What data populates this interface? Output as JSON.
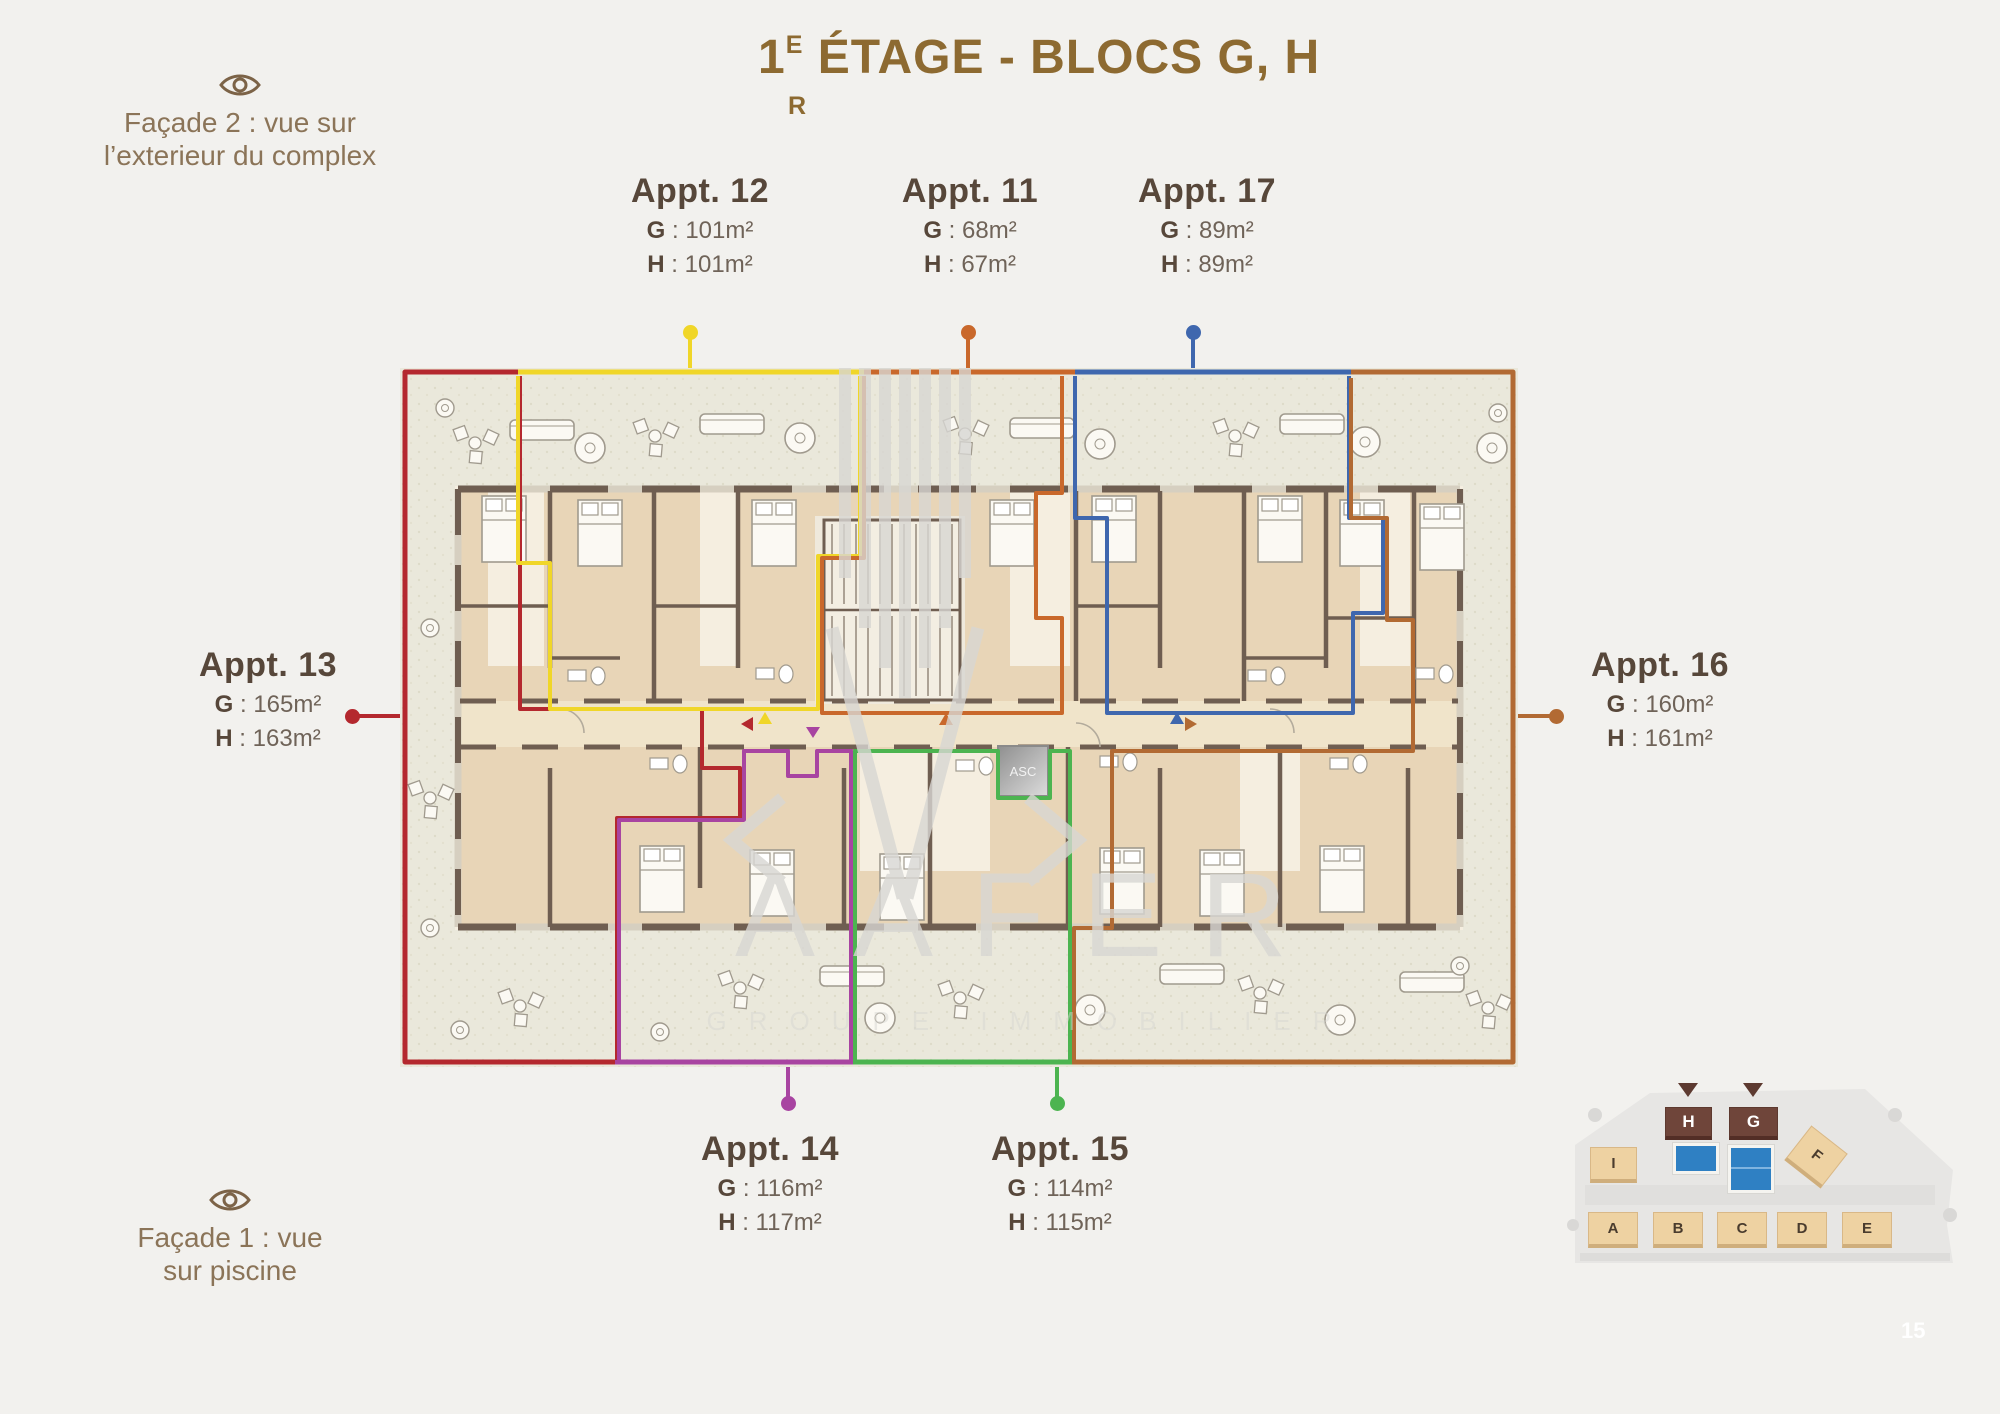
{
  "title": {
    "prefix": "1",
    "superscript_top": "E",
    "superscript_bottom": "R",
    "rest": " ÉTAGE - BLOCS G, H"
  },
  "facade_top": {
    "line1": "Façade 2 : vue sur",
    "line2": "l’exterieur du complex"
  },
  "facade_bottom": {
    "line1": "Façade 1 : vue",
    "line2": "sur piscine"
  },
  "separator": " : ",
  "apartments": [
    {
      "name": "Appt. 12",
      "g_key": "G",
      "g_value": "101m²",
      "h_key": "H",
      "h_value": "101m²",
      "color": "#f0d628"
    },
    {
      "name": "Appt. 11",
      "g_key": "G",
      "g_value": "68m²",
      "h_key": "H",
      "h_value": "67m²",
      "color": "#c9682b"
    },
    {
      "name": "Appt. 17",
      "g_key": "G",
      "g_value": "89m²",
      "h_key": "H",
      "h_value": "89m²",
      "color": "#3f67ae"
    },
    {
      "name": "Appt. 13",
      "g_key": "G",
      "g_value": "165m²",
      "h_key": "H",
      "h_value": "163m²",
      "color": "#b4282e"
    },
    {
      "name": "Appt. 16",
      "g_key": "G",
      "g_value": "160m²",
      "h_key": "H",
      "h_value": "161m²",
      "color": "#b26a33"
    },
    {
      "name": "Appt. 14",
      "g_key": "G",
      "g_value": "116m²",
      "h_key": "H",
      "h_value": "117m²",
      "color": "#a844a1"
    },
    {
      "name": "Appt. 15",
      "g_key": "G",
      "g_value": "114m²",
      "h_key": "H",
      "h_value": "115m²",
      "color": "#4cb450"
    }
  ],
  "floor_plan": {
    "elevator_label": "ASC"
  },
  "watermark": {
    "logo_text": "AAFER",
    "tagline": "GROUPE IMMOBILIER"
  },
  "site_map": {
    "blocks": [
      {
        "label": "H",
        "highlighted": true
      },
      {
        "label": "G",
        "highlighted": true
      },
      {
        "label": "I",
        "highlighted": false
      },
      {
        "label": "F",
        "highlighted": false
      },
      {
        "label": "A",
        "highlighted": false
      },
      {
        "label": "B",
        "highlighted": false
      },
      {
        "label": "C",
        "highlighted": false
      },
      {
        "label": "D",
        "highlighted": false
      },
      {
        "label": "E",
        "highlighted": false
      }
    ]
  },
  "page_number": "15",
  "colors": {
    "page_bg": "#f2f1ee",
    "title_brown": "#8d6a31",
    "text_dark": "#57473a",
    "text_mid": "#6f6358",
    "facade_brown": "#8b7458",
    "eye_brown": "#7c6347",
    "wall": "#6f5e51",
    "plan_bg": "#eae8db",
    "room_tan": "#e8d5b7",
    "room_cream": "#f5eee0",
    "corridor": "#f0e4ca",
    "watermark_gray": "#d8d7d3",
    "map_tan": "#eed2a2",
    "map_brown": "#6f453a",
    "pool_blue": "#2f80c3"
  }
}
